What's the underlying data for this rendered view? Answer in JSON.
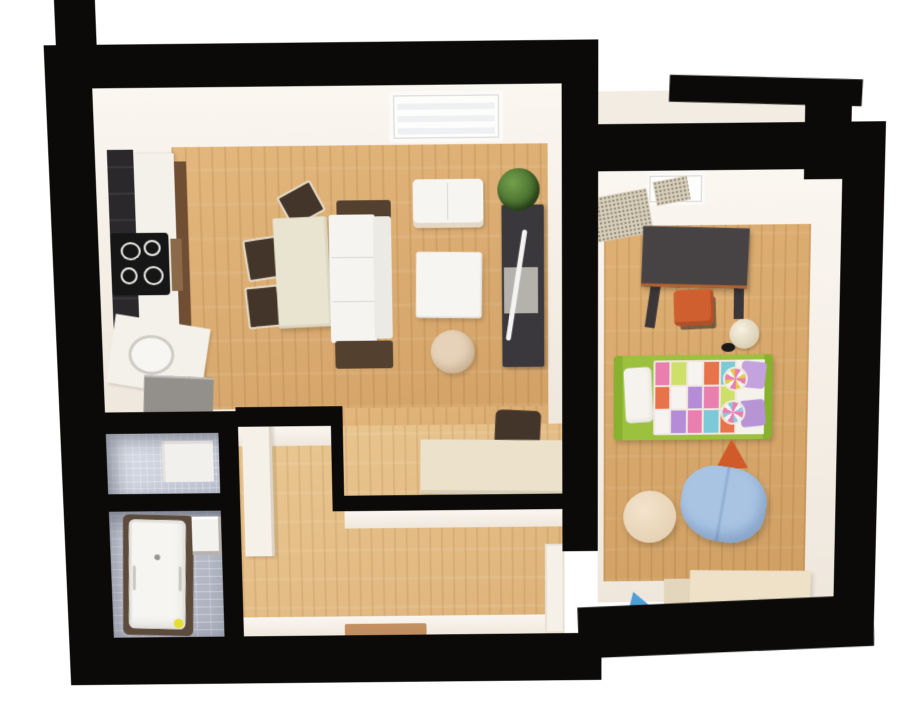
{
  "scene": {
    "kind": "3d-apartment-floor-plan-render",
    "background": "#ffffff"
  },
  "palette": {
    "wall_black": "#0b0a08",
    "wall_face_white": "#f7f2ea",
    "backsplash_dark": "#2b282c",
    "counter_white": "#f4f1ea",
    "cabinet_brown": "#6f4e33",
    "cabinet_grey": "#93908c",
    "cooktop_black": "#161616",
    "table_cream": "#e9e4cf",
    "chair_dark_brown": "#44352a",
    "sofa_white": "#f6f4f0",
    "sofa_brown": "#54402f",
    "loveseat_white": "#f7f5f1",
    "pouf_beige": "#e6d2b8",
    "tv_cabinet_dark": "#3a383d",
    "tv_stand_grey": "#b5b2ac",
    "tv_white": "#f4f4f2",
    "plant_green": "#4e7a35",
    "desk_cream": "#ece2cc",
    "kids_desk_dark": "#474345",
    "desk_edge_orange": "#b5622f",
    "stool_orange": "#cf5f2f",
    "lamp_cream": "#f3ecd9",
    "lamp_base_black": "#1c1a18",
    "bed_frame_green": "#9cc13f",
    "bed_frame_green_dark": "#88b12f",
    "pillow_white": "#f6f3ee",
    "pillow_purple": "#c3a2dd",
    "pillow_purple_dark": "#b795d4",
    "sheet_white": "#f5f2ec",
    "quilt_pink": "#e87fae",
    "quilt_orange": "#e8734a",
    "quilt_purple": "#b48cd8",
    "quilt_lime": "#cfe06a",
    "quilt_teal": "#7cc9d8",
    "quilt_white": "#f7f3f0",
    "tri_orange": "#d05a28",
    "tri_blue": "#4d9fd6",
    "bean_chair_blue": "#a9c4e3",
    "kids_table_cream": "#eee1c8",
    "kids_table_side": "#e4d6bc",
    "tub_frame_brown": "#5c4b3d",
    "tub_white": "#f6f5f2",
    "duck_yellow": "#e6de2e",
    "washer_white": "#f2f0ec",
    "sink_white": "#f4f2ee",
    "door_white": "#f6f1e8",
    "doormat_brown": "#b5773f",
    "balcony_floor": "#f2ece2",
    "window_white": "#fdfdfc",
    "window_glass": "#eef0f2"
  },
  "rooms": [
    {
      "name": "kitchen-living-room",
      "floor": "wood"
    },
    {
      "name": "kids-bedroom",
      "floor": "wood"
    },
    {
      "name": "hallway",
      "floor": "wood"
    },
    {
      "name": "wc",
      "walls": "mosaic-tile"
    },
    {
      "name": "bathroom",
      "walls": "grey-tile"
    },
    {
      "name": "balcony",
      "floor": "light"
    }
  ],
  "furniture": {
    "kitchen_living_room": [
      "kitchen-backsplash",
      "kitchen-tall-counter",
      "cooktop-4-burners",
      "oven",
      "kitchen-low-counter",
      "round-sink",
      "grey-base-cabinet",
      "dining-table",
      "dining-chair",
      "dining-chair",
      "dining-chair",
      "sofa-bed",
      "loveseat",
      "square-armchair",
      "round-pouf",
      "tv-cabinet",
      "tv",
      "potted-plant",
      "window-radiator",
      "writing-desk",
      "desk-chair"
    ],
    "kids_bedroom": [
      "window",
      "granite-mat",
      "granite-mat",
      "kids-desk",
      "orange-stool",
      "floor-lamp",
      "kids-bed-patchwork-quilt",
      "white-pillow",
      "purple-pillow",
      "purple-pillow",
      "lollipop-cushion",
      "lollipop-cushion",
      "orange-triangle-pouf",
      "blue-bean-chair",
      "cream-round-pouf",
      "blue-triangle-pouf",
      "kids-table"
    ],
    "hallway": [
      "white-door-leaf",
      "door-jamb",
      "doormat"
    ],
    "wc": [
      "washing-machine"
    ],
    "bathroom": [
      "bathtub",
      "rubber-duck",
      "washbasin"
    ]
  },
  "bed": {
    "frame": "bed_frame_green",
    "quilt": [
      [
        "pink",
        "lime",
        "white",
        "orange",
        "teal"
      ],
      [
        "orange",
        "white",
        "purple",
        "pink",
        "lime"
      ],
      [
        "white",
        "purple",
        "pink",
        "teal",
        "orange"
      ]
    ]
  }
}
